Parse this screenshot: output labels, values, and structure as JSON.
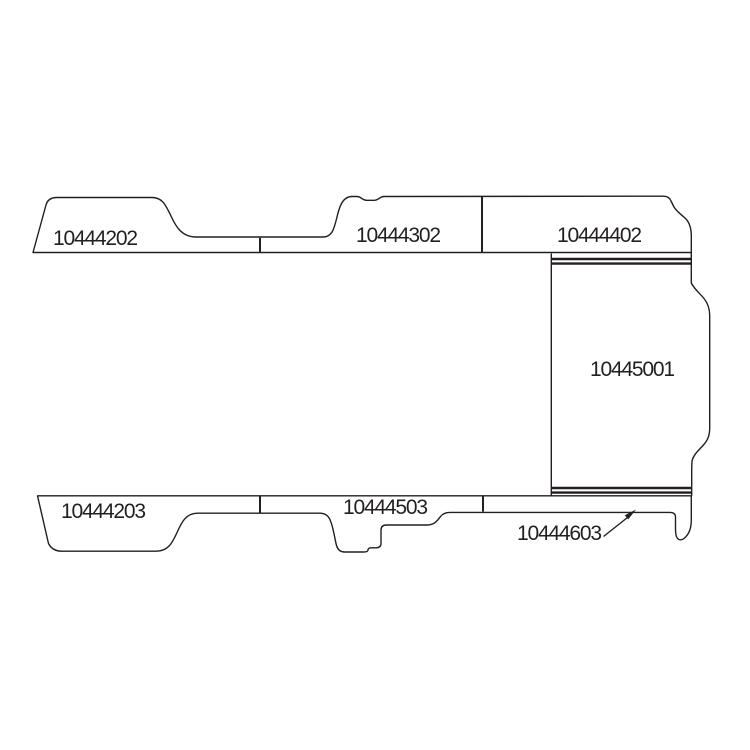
{
  "diagram": {
    "background_color": "#ffffff",
    "line_color": "#231f20",
    "description": "vehicle-panel-parts-diagram",
    "parts": [
      {
        "part_number": "10444202",
        "position": "top-left-panel"
      },
      {
        "part_number": "10444302",
        "position": "top-middle-panel"
      },
      {
        "part_number": "10444402",
        "position": "top-right-panel"
      },
      {
        "part_number": "10445001",
        "position": "right-large-panel"
      },
      {
        "part_number": "10444203",
        "position": "bottom-left-panel"
      },
      {
        "part_number": "10444503",
        "position": "bottom-middle-panel"
      },
      {
        "part_number": "10444603",
        "position": "bottom-right-strip",
        "has_leader_line": true
      }
    ]
  }
}
